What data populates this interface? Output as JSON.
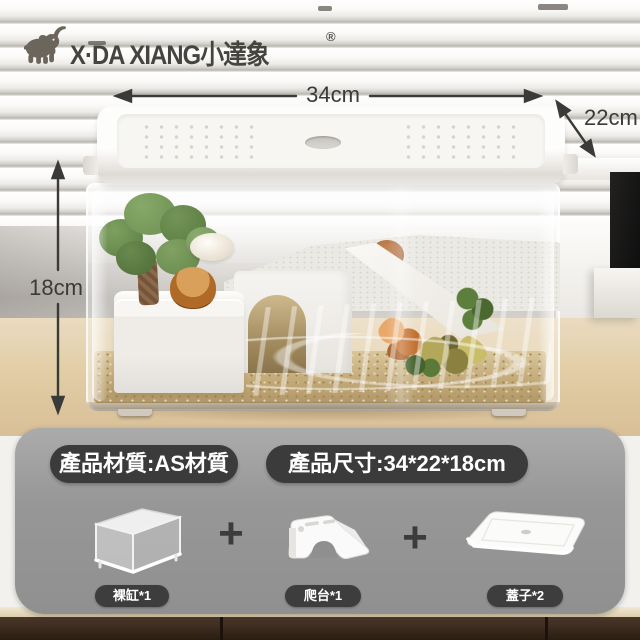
{
  "brand": {
    "icon": "elephant-icon",
    "name": "X·DA XIANG小達象",
    "registered_mark": "®"
  },
  "dimension_labels": {
    "width": "34cm",
    "depth": "22cm",
    "height": "18cm"
  },
  "info_panel": {
    "material_badge": "產品材質:AS材質",
    "size_badge": "產品尺寸:34*22*18cm",
    "plus_sign": "+",
    "items": [
      {
        "id": "bare-tank",
        "label": "裸缸*1"
      },
      {
        "id": "climbing-platform",
        "label": "爬台*1"
      },
      {
        "id": "lids",
        "label": "蓋子*2"
      }
    ]
  },
  "colors": {
    "annotation_dark": "#3a3a38",
    "badge_bg": "#3b3b3b",
    "panel_gray": "#9b9b9b",
    "desk_wood": "#e2cda6",
    "cabinet_wood": "#33241a"
  }
}
